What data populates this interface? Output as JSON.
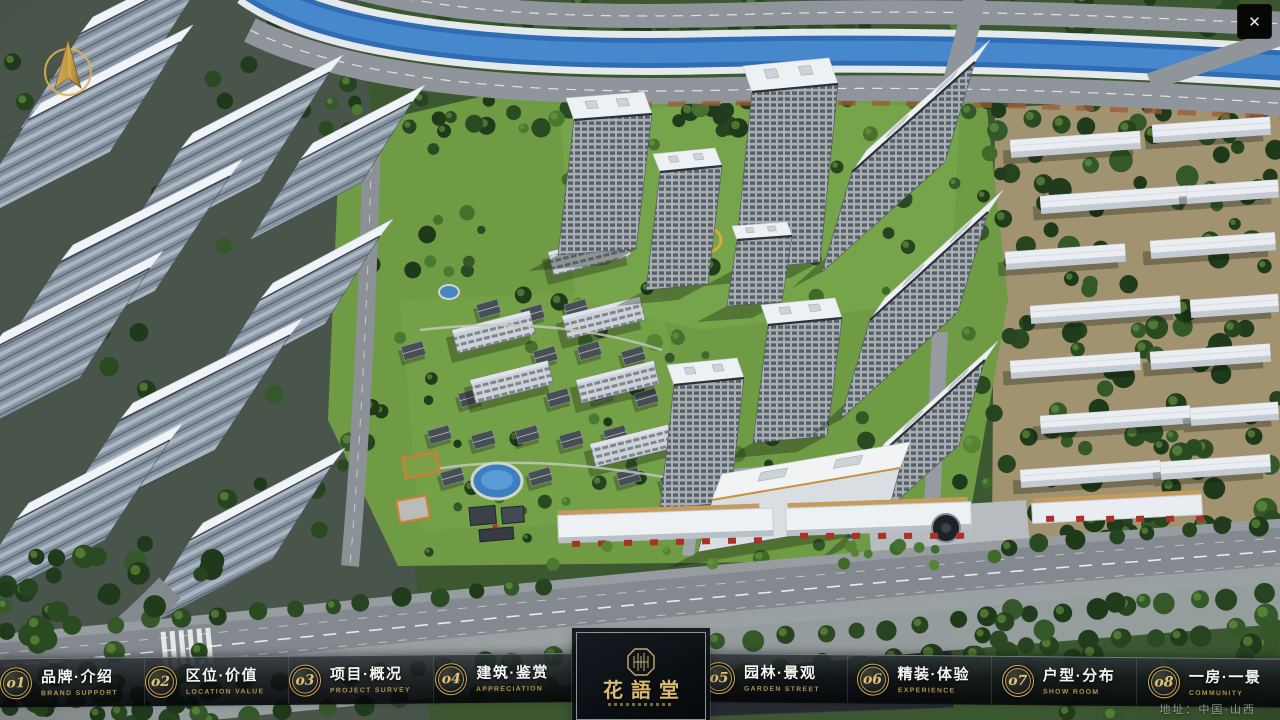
{
  "window": {
    "close_icon": "✕"
  },
  "nav": {
    "items": [
      {
        "num": "o1",
        "label": "品牌·介绍",
        "sub": "BRAND SUPPORT"
      },
      {
        "num": "o2",
        "label": "区位·价值",
        "sub": "LOCATION VALUE"
      },
      {
        "num": "o3",
        "label": "项目·概况",
        "sub": "PROJECT SURVEY"
      },
      {
        "num": "o4",
        "label": "建筑·鉴赏",
        "sub": "APPRECIATION"
      },
      {
        "num": "o5",
        "label": "园林·景观",
        "sub": "GARDEN STREET"
      },
      {
        "num": "o6",
        "label": "精装·体验",
        "sub": "EXPERIENCE"
      },
      {
        "num": "o7",
        "label": "户型·分布",
        "sub": "SHOW ROOM"
      },
      {
        "num": "o8",
        "label": "一房·一景",
        "sub": "COMMUNITY"
      }
    ]
  },
  "logo": {
    "title": "花語堂"
  },
  "footer": {
    "address": "地址：中国·山西"
  },
  "theme": {
    "gold": "#d2ab5e",
    "bar_bg": "rgba(10,14,17,0.86)",
    "plate_bg": "#0b1014"
  }
}
